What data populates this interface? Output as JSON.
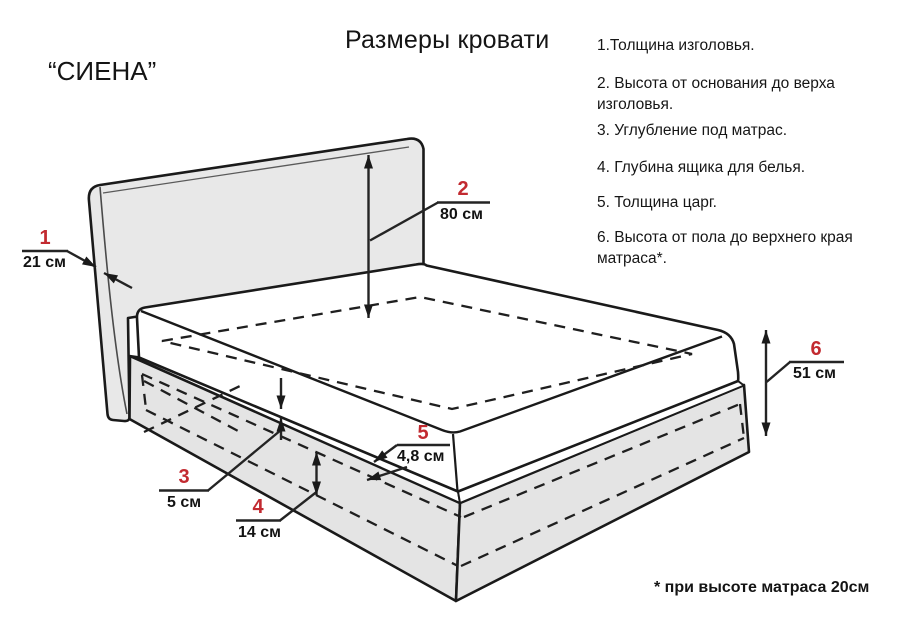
{
  "page": {
    "title": "Размеры кровати",
    "model": "“СИЕНА”",
    "footnote": "* при высоте матраса 20см"
  },
  "legend": {
    "items": [
      {
        "text": "1.Толщина изголовья."
      },
      {
        "text": "2. Высота от основания до верха изголовья."
      },
      {
        "text": "3. Углубление под матрас."
      },
      {
        "text": "4. Глубина ящика для белья."
      },
      {
        "text": "5. Толщина царг."
      },
      {
        "text": "6. Высота от пола до верхнего края матраса*."
      }
    ]
  },
  "dimensions": [
    {
      "num": "1",
      "value": "21 см"
    },
    {
      "num": "2",
      "value": "80 см"
    },
    {
      "num": "3",
      "value": "5 см"
    },
    {
      "num": "4",
      "value": "14 см"
    },
    {
      "num": "5",
      "value": "4,8 см"
    },
    {
      "num": "6",
      "value": "51 см"
    }
  ],
  "colors": {
    "accent_red": "#c22a30",
    "line": "#1a1a1a",
    "headboard_fill": "#e8e8e8",
    "base_fill": "#e4e4e4",
    "background": "#ffffff"
  }
}
